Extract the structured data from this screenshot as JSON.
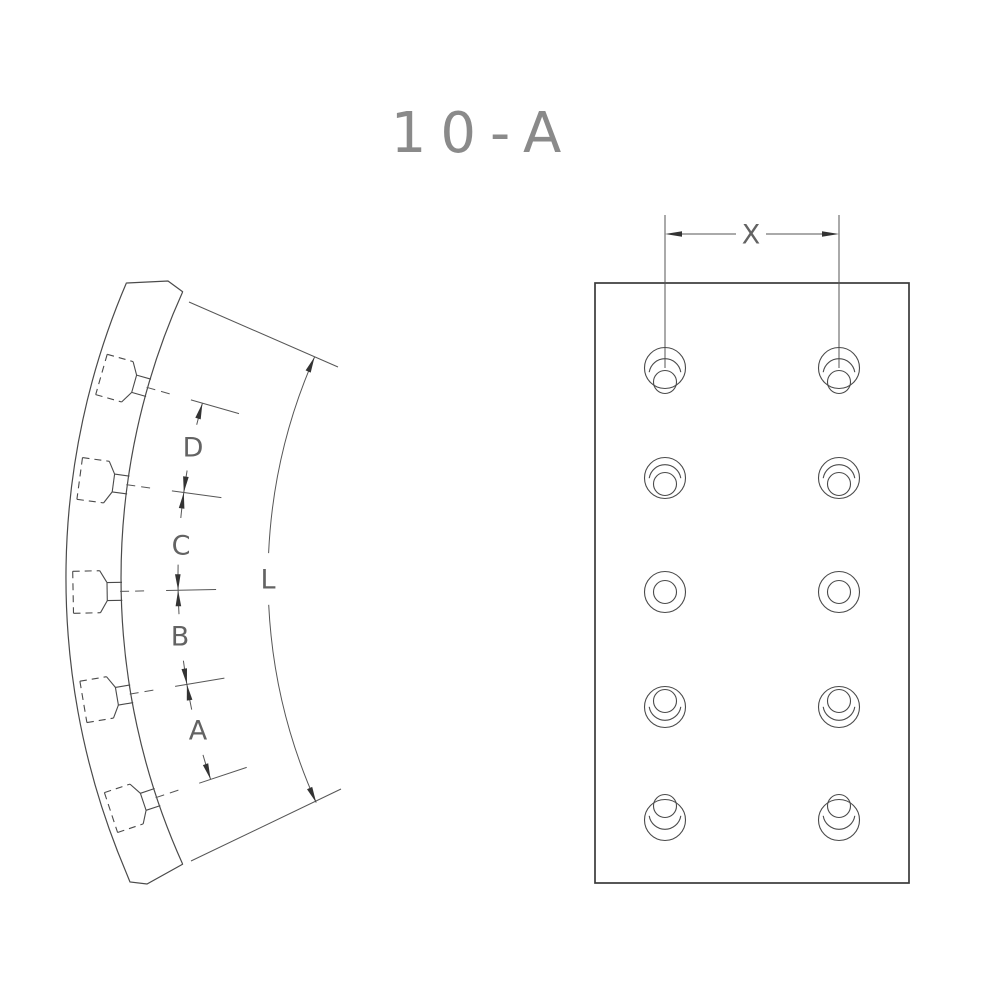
{
  "title": "10-A",
  "colors": {
    "background": "#ffffff",
    "line": "#4a4a4a",
    "dimension_line": "#565656",
    "arrow_fill": "#333333",
    "label_text": "#636363",
    "title_text": "#8a8a8a",
    "frame": "#3a3a3a"
  },
  "views": {
    "side": {
      "arc_length_label": "L",
      "rivet_spacing_labels": [
        "D",
        "C",
        "B",
        "A"
      ],
      "rivet_count": 5
    },
    "flat": {
      "column_spacing_label": "X",
      "hole_rows": 5,
      "hole_columns": 2,
      "hole_count": 10
    }
  }
}
